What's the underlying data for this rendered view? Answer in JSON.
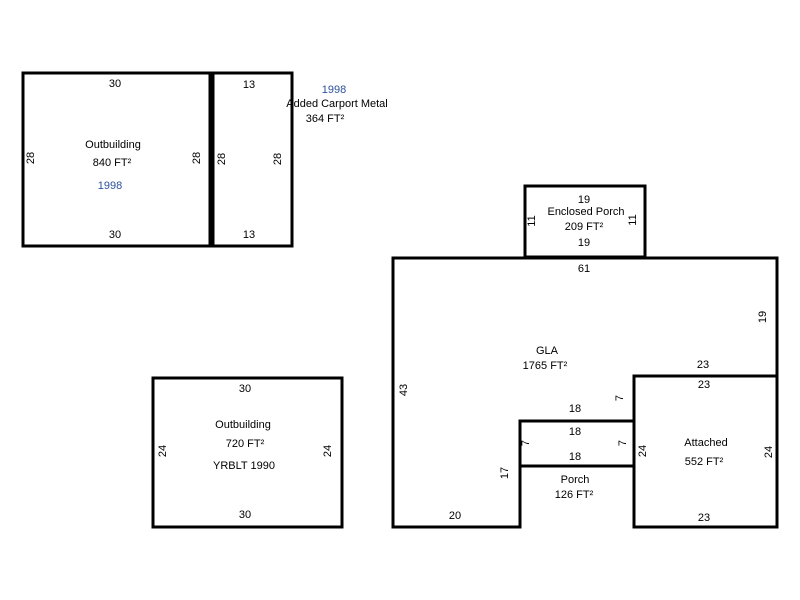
{
  "page": {
    "background_color": "#ffffff",
    "line_color": "#000000",
    "text_color": "#000000",
    "year_color": "#2d4f9e"
  },
  "structures": {
    "outbuilding1": {
      "name": "Outbuilding",
      "area": "840 FT²",
      "year": "1998",
      "dim_top": "30",
      "dim_bottom": "30",
      "dim_left": "28",
      "dim_right": "28"
    },
    "carport": {
      "dim_top": "13",
      "dim_bottom": "13",
      "dim_left": "28",
      "dim_right": "28"
    },
    "carport_note": {
      "year": "1998",
      "name": "Added Carport Metal",
      "area": "364 FT²"
    },
    "outbuilding2": {
      "name": "Outbuilding",
      "area": "720 FT²",
      "yrblt": "YRBLT 1990",
      "dim_top": "30",
      "dim_bottom": "30",
      "dim_left": "24",
      "dim_right": "24"
    },
    "enclosed_porch": {
      "name": "Enclosed Porch",
      "area": "209 FT²",
      "dim_top": "19",
      "dim_bottom": "19",
      "dim_left": "11",
      "dim_right": "11"
    },
    "gla": {
      "name": "GLA",
      "area": "1765 FT²",
      "dim_top": "61",
      "dim_right": "19",
      "dim_left": "43",
      "dim_step23": "23",
      "dim_step7": "7",
      "dim_step18": "18",
      "dim_step17": "17",
      "dim_bottom": "20"
    },
    "attached": {
      "name": "Attached",
      "area": "552 FT²",
      "dim_top": "23",
      "dim_bottom": "23",
      "dim_left": "24",
      "dim_right": "24"
    },
    "porch": {
      "name": "Porch",
      "area": "126 FT²",
      "dim_top": "18",
      "dim_bottom": "18",
      "dim_left": "7",
      "dim_right": "7"
    }
  }
}
